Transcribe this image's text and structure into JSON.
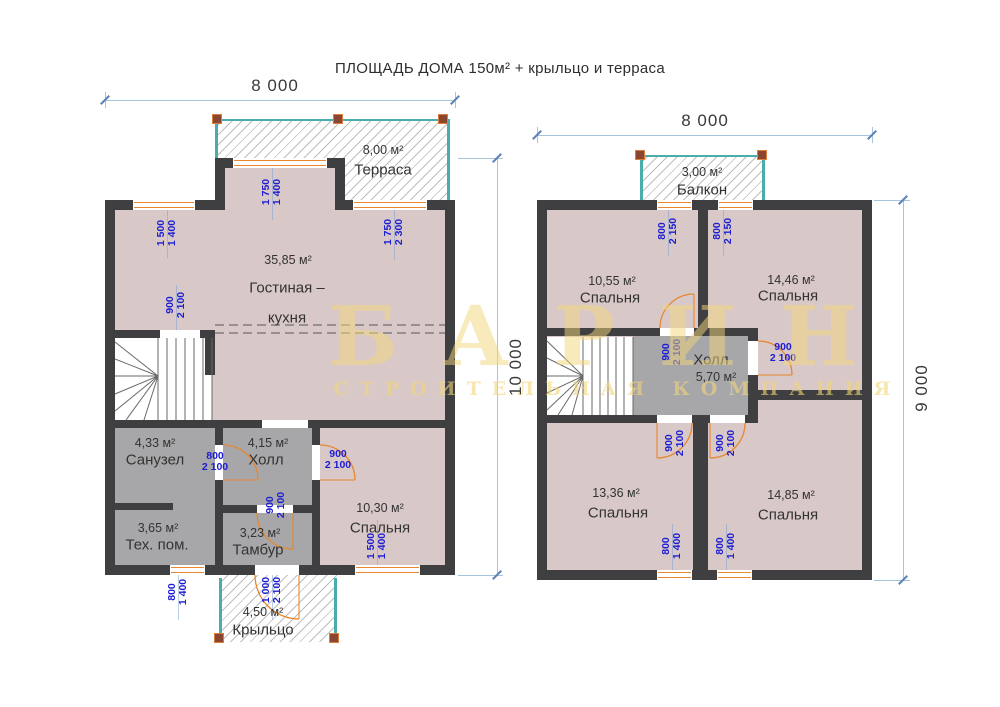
{
  "title": "ПЛОЩАДЬ ДОМА 150м² + крыльцо и терраса",
  "watermark": {
    "brand": "БАРИН",
    "tagline": "СТРОИТЕЛЬНАЯ КОМПАНИЯ"
  },
  "floor1": {
    "dim_width": "8 000",
    "dim_height": "10 000",
    "terrace": {
      "area": "8,00 м²",
      "name": "Терраса"
    },
    "living": {
      "area": "35,85 м²",
      "name_line1": "Гостиная –",
      "name_line2": "кухня"
    },
    "bathroom": {
      "area": "4,33 м²",
      "name": "Санузел"
    },
    "hall": {
      "area": "4,15 м²",
      "name": "Холл"
    },
    "tech": {
      "area": "3,65 м²",
      "name": "Тех. пом."
    },
    "tambour": {
      "area": "3,23 м²",
      "name": "Тамбур"
    },
    "bedroom": {
      "area": "10,30 м²",
      "name": "Спальня"
    },
    "porch": {
      "area": "4,50 м²",
      "name": "Крыльцо"
    },
    "openings": {
      "window_left": {
        "w": "1 500",
        "h": "1 400"
      },
      "window_bay": {
        "w": "1 750",
        "h": "1 400"
      },
      "terrace_door": {
        "w": "1 750",
        "h": "2 300"
      },
      "stairs_opening": {
        "w": "900",
        "h": "2 100"
      },
      "bathroom_door": {
        "w": "800",
        "h": "2 100"
      },
      "tambour_door": {
        "w": "900",
        "h": "2 100"
      },
      "bedroom_door": {
        "w": "900",
        "h": "2 100"
      },
      "bedroom_window": {
        "w": "1 500",
        "h": "1 400"
      },
      "tech_window": {
        "w": "800",
        "h": "1 400"
      },
      "porch_door": {
        "w": "1 000",
        "h": "2 100"
      }
    }
  },
  "floor2": {
    "dim_width": "8 000",
    "dim_height": "9 000",
    "balcony": {
      "area": "3,00 м²",
      "name": "Балкон"
    },
    "bedroom_tl": {
      "area": "10,55 м²",
      "name": "Спальня"
    },
    "bedroom_tr": {
      "area": "14,46 м²",
      "name": "Спальня"
    },
    "hall": {
      "area": "5,70 м²",
      "name": "Холл"
    },
    "bedroom_bl": {
      "area": "13,36 м²",
      "name": "Спальня"
    },
    "bedroom_br": {
      "area": "14,85 м²",
      "name": "Спальня"
    },
    "openings": {
      "balcony_door_left": {
        "w": "800",
        "h": "2 150"
      },
      "balcony_door_right": {
        "w": "800",
        "h": "2 150"
      },
      "bedroom_tl_door": {
        "w": "900",
        "h": "2 100"
      },
      "bedroom_tr_door": {
        "w": "900",
        "h": "2 100"
      },
      "bedroom_bl_door": {
        "w": "900",
        "h": "2 100"
      },
      "bedroom_br_door": {
        "w": "900",
        "h": "2 100"
      },
      "window_left": {
        "w": "800",
        "h": "1 400"
      },
      "window_right": {
        "w": "800",
        "h": "1 400"
      }
    }
  },
  "colors": {
    "wall": "#3f3e40",
    "room_warm": "#d9c8c8",
    "room_gray": "#a7a7a9",
    "hatch_line": "#bdbdbd",
    "teal": "#4aacab",
    "post": "#8a4631",
    "post_border": "#dd7f3c",
    "door": "#e8872d",
    "dim_text": "#1d1dd2",
    "dim_line": "#a9c3d9",
    "text": "#333333",
    "watermark": "#f3d67a"
  }
}
